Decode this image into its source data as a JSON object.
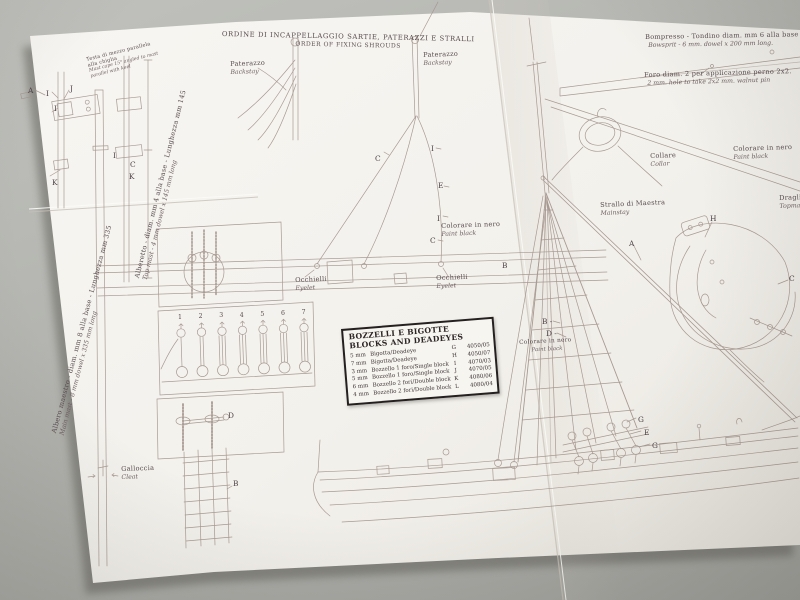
{
  "colors": {
    "background": "#b2b3ae",
    "paper": "#f5f3ee",
    "ink": "#a3938c",
    "text": "#564a4e",
    "table_border": "#242020"
  },
  "title": {
    "it": "ORDINE DI INCAPPELLAGGIO SARTIE, PATERAZZI E STRALLI",
    "en": "ORDER OF FIXING SHROUDS"
  },
  "notes": {
    "mast_cap_it": "Testa di mezzo parallela alla chiglia",
    "mast_cap_en": "Mast cape 15° angled to mast parallel with keel",
    "bowsprit_it": "Bompresso - Tondino diam. mm 6 alla base - Lunghezza",
    "bowsprit_en": "Bowsprit - 6 mm. dowel x 200 mm long.",
    "hole_it": "Foro diam. 2 per applicazione perno 2x2.",
    "hole_en": "2 mm. hole to take 2x2 mm. walnut pin"
  },
  "spar_labels": {
    "topmast_it": "Alberetto - diam. mm 4 alla base - Lunghezza mm 145",
    "topmast_en": "Top mast - 4 mm dowel x 145 mm long",
    "mainmast_it": "Albero maestro - diam. mm 8 alla base - Lunghezza mm 335",
    "mainmast_en": "Main mast - 8 mm dowel x 335 mm long"
  },
  "part_labels": {
    "backstay_it": "Paterazzo",
    "backstay_en": "Backstay",
    "eyelet_it": "Occhielli",
    "eyelet_en": "Eyelet",
    "paint_it": "Colorare in nero",
    "paint_en": "Paint black",
    "collar_it": "Collare",
    "collar_en": "Collar",
    "mainstay_it": "Strallo di Maestra",
    "mainstay_en": "Mainstay",
    "topmast_stay_it": "Draglia",
    "topmast_stay_en": "Topmast",
    "cleat_it": "Galloccia",
    "cleat_en": "Cleat"
  },
  "parts_table": {
    "title_it": "BOZZELLI E BIGOTTE",
    "title_en": "BLOCKS AND DEADEYES",
    "rows": [
      {
        "size": "5 mm",
        "name": "Bigotta/Deadeye",
        "letter": "G",
        "code": "4050/05"
      },
      {
        "size": "7 mm",
        "name": "Bigotta/Deadeye",
        "letter": "H",
        "code": "4050/07"
      },
      {
        "size": "3 mm",
        "name": "Bozzello 1 foro/Single block",
        "letter": "I",
        "code": "4070/03"
      },
      {
        "size": "5 mm",
        "name": "Bozzello 1 foro/Single block",
        "letter": "J",
        "code": "4070/05"
      },
      {
        "size": "6 mm",
        "name": "Bozzello 2 fori/Double block",
        "letter": "K",
        "code": "4080/06"
      },
      {
        "size": "4 mm",
        "name": "Bozzello 2 fori/Double block",
        "letter": "L",
        "code": "4080/04"
      }
    ]
  },
  "sequence_numbers": [
    "1",
    "2",
    "3",
    "4",
    "5",
    "6",
    "7"
  ],
  "annotation_letters": [
    {
      "t": "A",
      "x": 28,
      "y": 86
    },
    {
      "t": "I",
      "x": 46,
      "y": 89
    },
    {
      "t": "J",
      "x": 70,
      "y": 84
    },
    {
      "t": "I",
      "x": 54,
      "y": 104
    },
    {
      "t": "K",
      "x": 52,
      "y": 178
    },
    {
      "t": "I",
      "x": 113,
      "y": 151
    },
    {
      "t": "C",
      "x": 130,
      "y": 160
    },
    {
      "t": "K",
      "x": 129,
      "y": 172
    },
    {
      "t": "C",
      "x": 375,
      "y": 154
    },
    {
      "t": "I",
      "x": 431,
      "y": 144
    },
    {
      "t": "E",
      "x": 438,
      "y": 181
    },
    {
      "t": "I",
      "x": 437,
      "y": 214
    },
    {
      "t": "C",
      "x": 430,
      "y": 236
    },
    {
      "t": "B",
      "x": 502,
      "y": 261
    },
    {
      "t": "B -",
      "x": 542,
      "y": 317
    },
    {
      "t": "D -",
      "x": 546,
      "y": 329
    },
    {
      "t": "G",
      "x": 638,
      "y": 415
    },
    {
      "t": "E",
      "x": 644,
      "y": 428
    },
    {
      "t": "G",
      "x": 652,
      "y": 441
    },
    {
      "t": "H",
      "x": 710,
      "y": 214
    },
    {
      "t": "A",
      "x": 629,
      "y": 239
    },
    {
      "t": "C",
      "x": 789,
      "y": 274
    },
    {
      "t": "D",
      "x": 228,
      "y": 411
    },
    {
      "t": "B",
      "x": 233,
      "y": 479
    }
  ]
}
